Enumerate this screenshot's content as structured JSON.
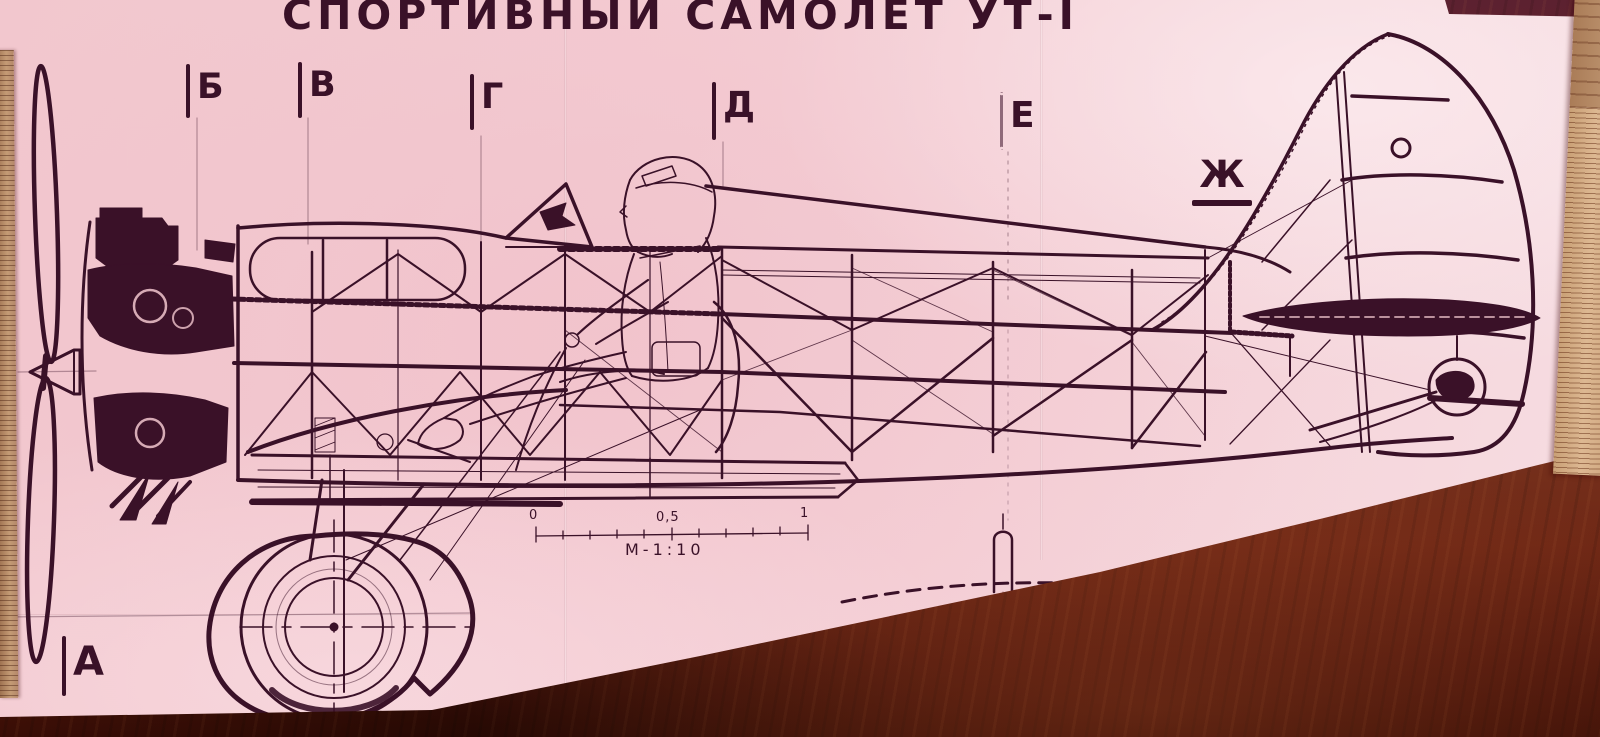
{
  "photo": {
    "title_block": {
      "title": "СПОРТИВНЫЙ САМОЛЁТ УТ-I"
    },
    "section_markers": [
      {
        "label": "Б"
      },
      {
        "label": "В"
      },
      {
        "label": "Г"
      },
      {
        "label": "Д"
      },
      {
        "label": "Е"
      },
      {
        "label": "Ж"
      },
      {
        "label": "А"
      }
    ],
    "scale_bar": {
      "zero": "0",
      "half": "0,5",
      "one": "1",
      "scale": "М-1:10"
    },
    "colors": {
      "paper_pink": "#f3ccd2",
      "ink": "#3a1128",
      "wood_maroon": "#5c2130",
      "wood_red_brown": "#7a3520",
      "wood_dark": "#390d05",
      "ruler_wood": "#ddb892"
    }
  }
}
